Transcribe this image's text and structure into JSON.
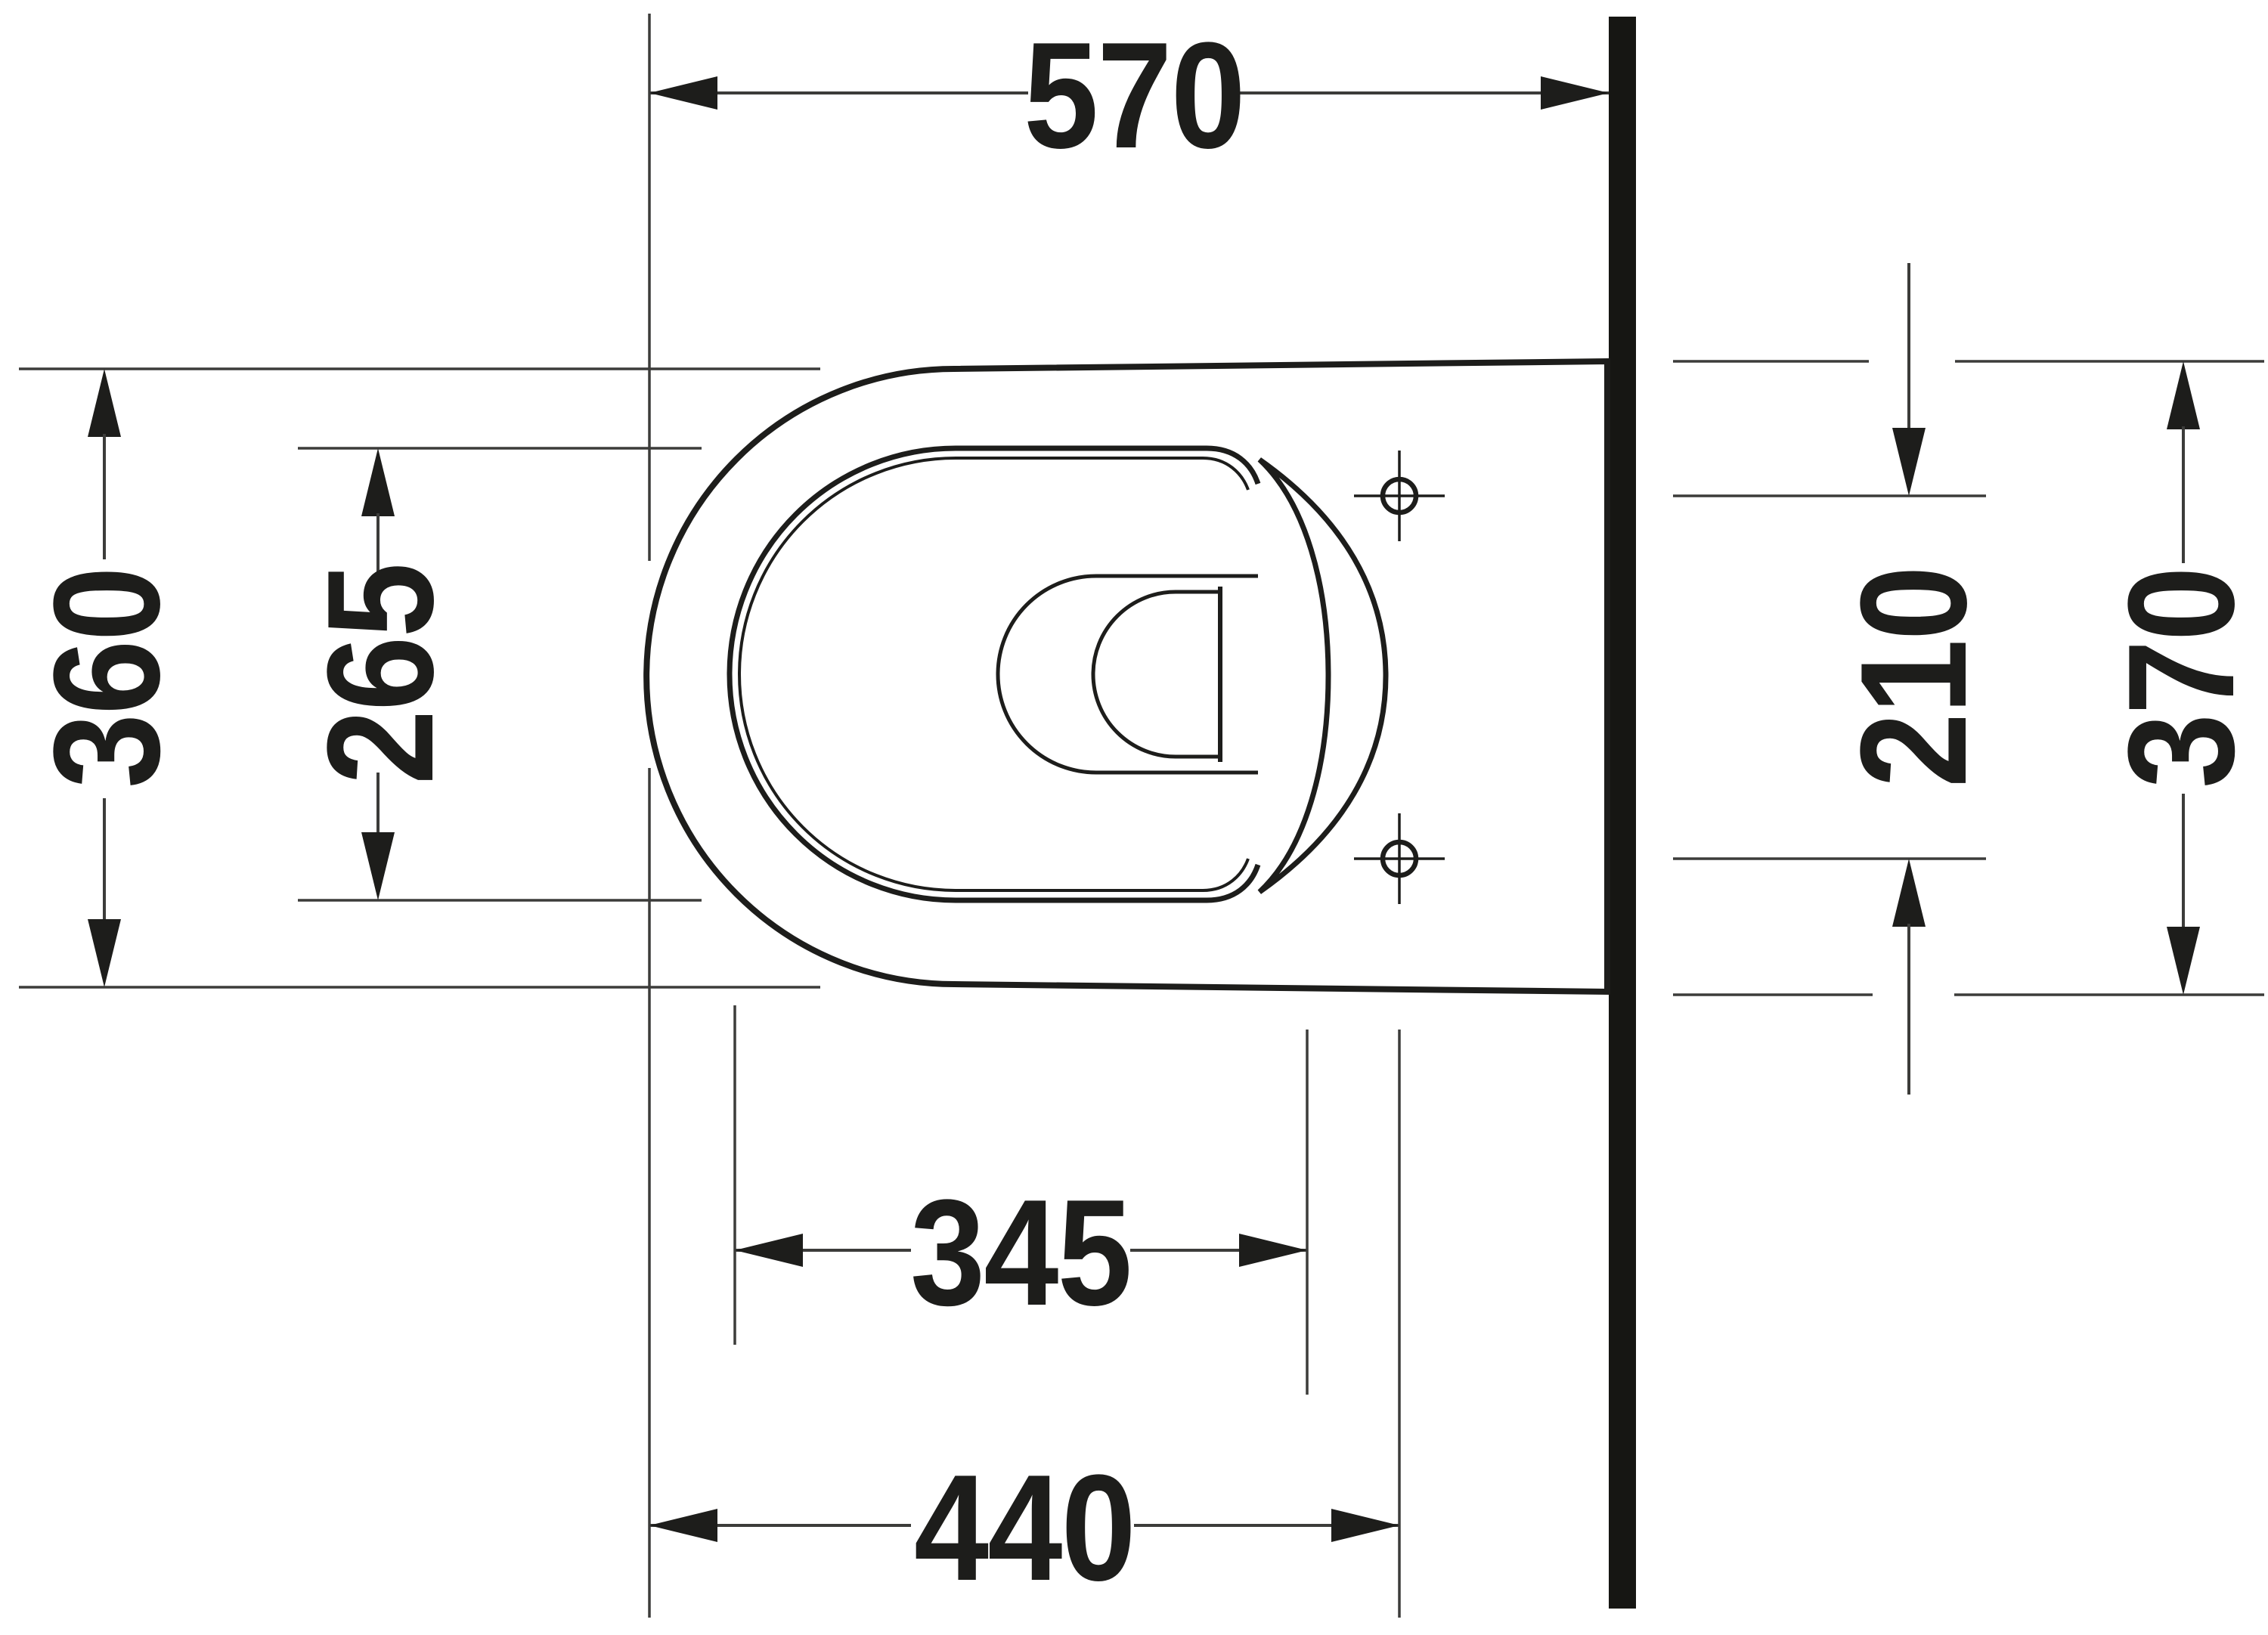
{
  "drawing": {
    "type": "technical-dimension-drawing",
    "labels": {
      "width_overall": "570",
      "depth_front": "360",
      "depth_seat_opening": "265",
      "fixing_hole_spacing": "210",
      "depth_at_wall": "370",
      "length_inner": "345",
      "length_fixing": "440"
    },
    "colors": {
      "background": "#ffffff",
      "ink": "#1d1d1b",
      "thin_line": "#3c3c3a",
      "wall": "#161613"
    }
  }
}
